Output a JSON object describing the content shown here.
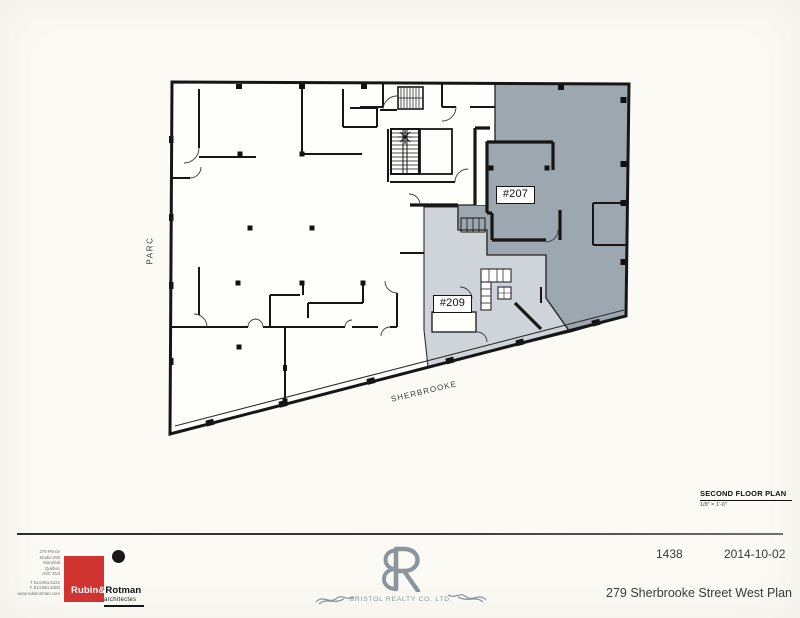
{
  "plan": {
    "label_parc": "PARC",
    "label_sherbrooke": "SHERBROOKE",
    "unit_207": "#207",
    "unit_209": "#209",
    "colors": {
      "unit_207_fill": "#9ca7af",
      "unit_209_fill": "#ced4d9",
      "wall": "#161616",
      "paper": "#fefefb"
    }
  },
  "plan_note": {
    "title": "SECOND FLOOR PLAN",
    "scale": "1/8\" = 1'-0\""
  },
  "titleblock": {
    "project_number": "1438",
    "date": "2014-10-02",
    "sheet_title": "279 Sherbrooke Street West Plan",
    "architect": {
      "name_first": "Rubin&",
      "name_last": "Rotman",
      "subtitle": "architectes",
      "brand_color": "#d13331",
      "address_lines": [
        "279 Prince",
        "Studio 250",
        "Montréal",
        "Québec",
        "H3C 2N3"
      ],
      "contact_lines": [
        "T 514.861.5122",
        "F 514.861.5383",
        "www.rubinrotman.com"
      ]
    },
    "realty": {
      "name": "BRISTOL REALTY CO. LTD.",
      "monogram": "BR",
      "color": "#8b959d"
    }
  }
}
